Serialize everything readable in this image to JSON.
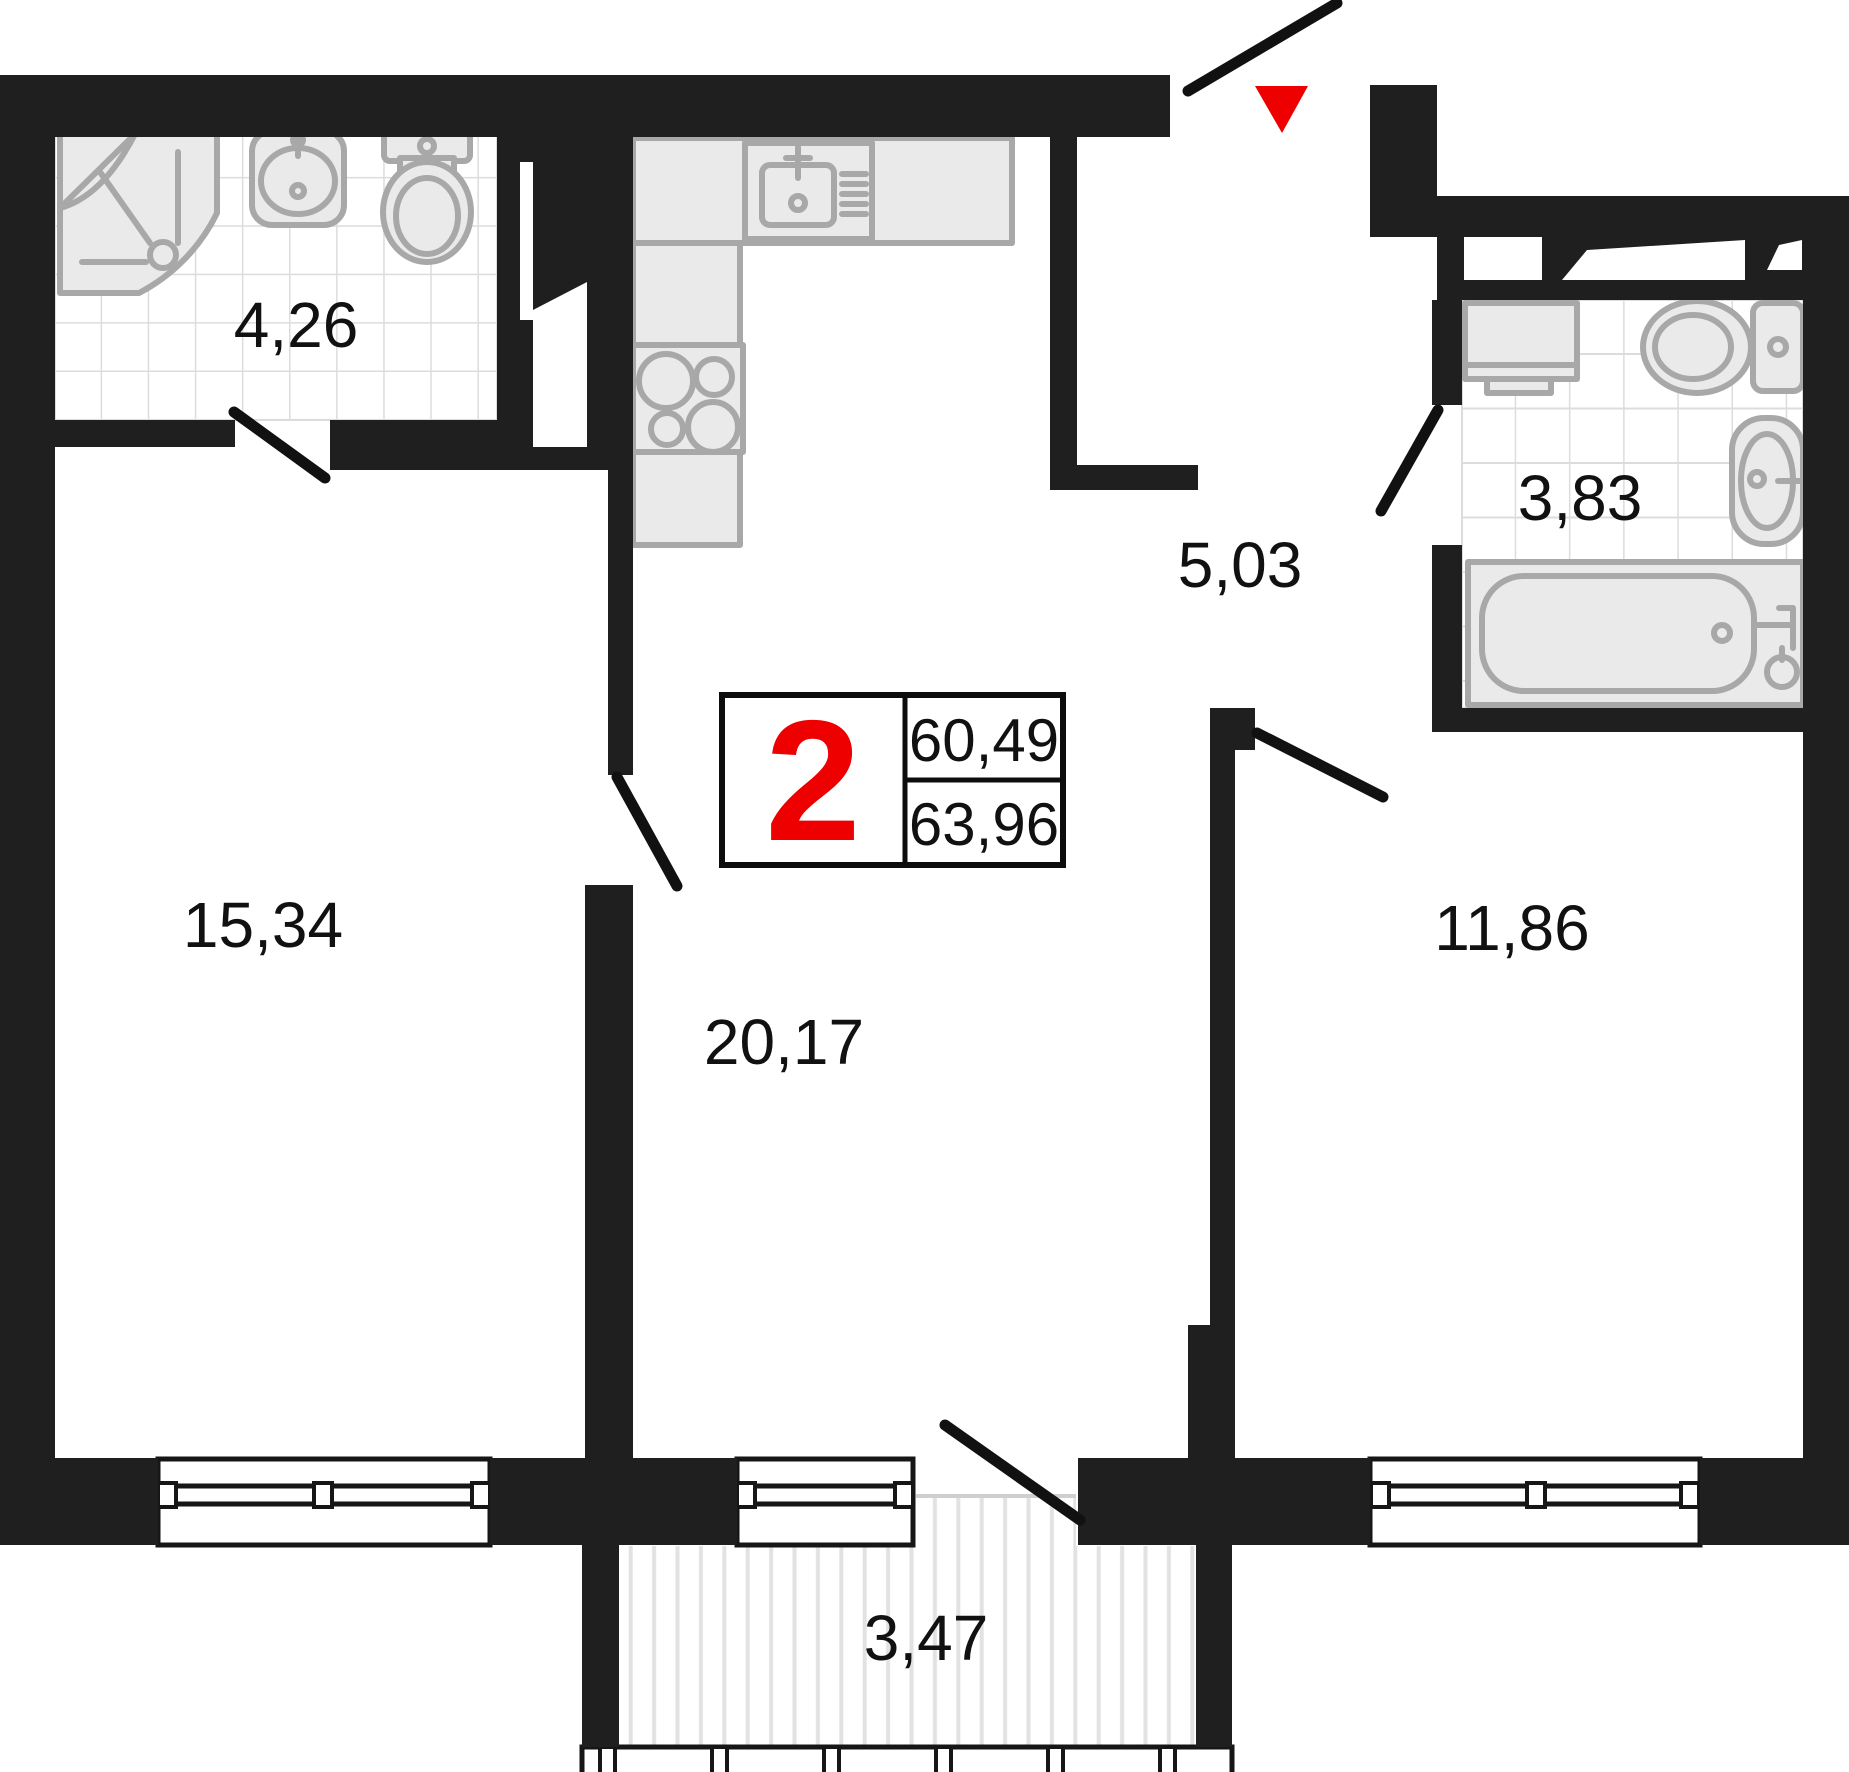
{
  "legend": {
    "rooms_count": "2",
    "area_living": "60,49",
    "area_total": "63,96"
  },
  "rooms": {
    "bathroom_small": {
      "area": "4,26"
    },
    "bedroom_left": {
      "area": "15,34"
    },
    "living_kitchen": {
      "area": "20,17"
    },
    "hallway": {
      "area": "5,03"
    },
    "bathroom_large": {
      "area": "3,83"
    },
    "bedroom_right": {
      "area": "11,86"
    },
    "balcony": {
      "area": "3,47"
    }
  },
  "colors": {
    "wall": "#1f1f1f",
    "accent_red": "#ee0000",
    "fixture_stroke": "#a8a8a8",
    "fixture_fill": "#eaeaea",
    "tile_line": "#dcdcdc",
    "hatch_line": "#e2e2e2",
    "door_line": "#111111",
    "text": "#111111"
  }
}
